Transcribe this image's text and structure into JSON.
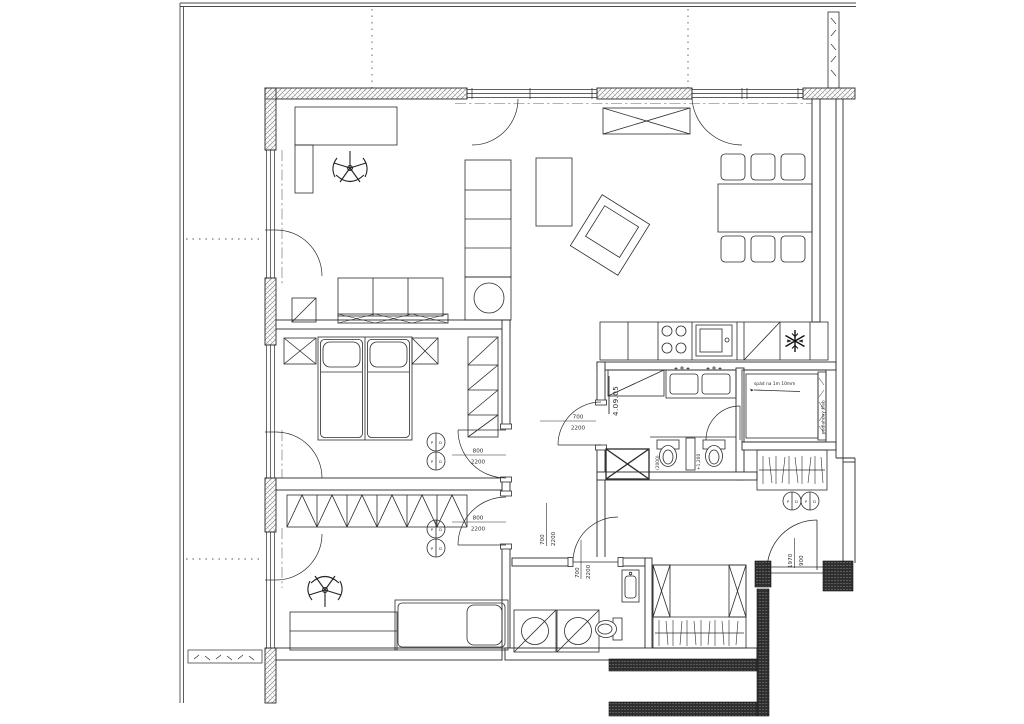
{
  "plan": {
    "unit_number": "4.09.05",
    "doors": {
      "bedroom1": {
        "width": "800",
        "height": "2200"
      },
      "bedroom2": {
        "width": "800",
        "height": "2200"
      },
      "bathroom": {
        "width": "700",
        "height": "2200"
      },
      "hall": {
        "width": "700",
        "height": "2200"
      },
      "laundry": {
        "width": "700",
        "height": "2200"
      },
      "entrance": {
        "width": "900",
        "height": "1970"
      }
    },
    "annotations": {
      "shower_slope": "spád na 1m 10mm",
      "floor_drain": "podlahový žľab",
      "wc_niche_width": "(2000)",
      "wc_wall_level": "+1,200"
    },
    "symbols": {
      "letter_p": "P",
      "letter_d": "D"
    },
    "colors": {
      "line": "#2b2b2b",
      "hatch": "#8a8a8a",
      "dark_wall": "#2f2f2f"
    }
  }
}
